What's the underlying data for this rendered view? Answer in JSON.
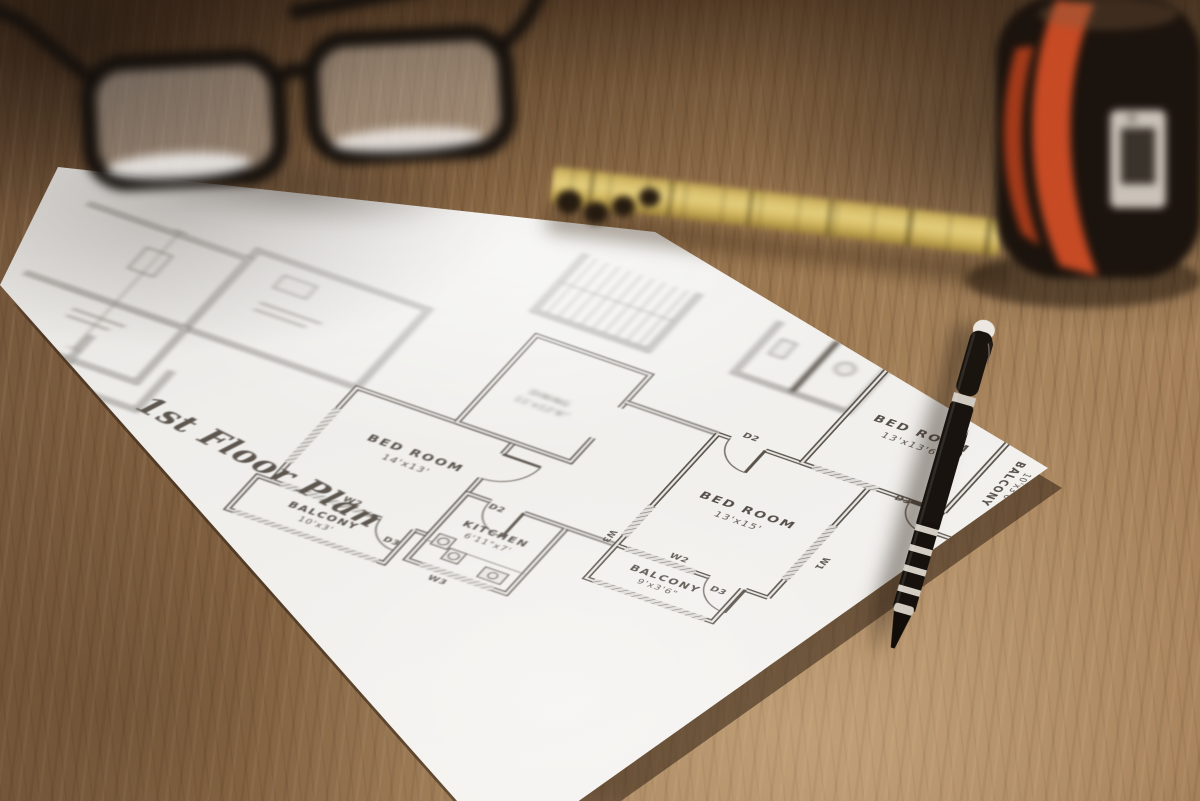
{
  "photo": {
    "surface": "wooden-table",
    "objects": [
      "eyeglasses",
      "folding-ruler",
      "tape-measure",
      "ballpoint-pen",
      "floor-plan-sheet"
    ],
    "colors": {
      "wood": "#8a6a48",
      "paper": "#efedea",
      "ink": "#57504a",
      "ruler_yellow": "#d8bf6a",
      "tape_accent": "#c64a24",
      "pen_black": "#17120d"
    }
  },
  "plan": {
    "title": "1st Floor Plan",
    "rooms": [
      {
        "id": "bedroom-left",
        "name": "BED ROOM",
        "dims": "14'x13'"
      },
      {
        "id": "balcony-left",
        "name": "BALCONY",
        "dims": "10'x3'"
      },
      {
        "id": "kitchen",
        "name": "KITCHEN",
        "dims": "6'11\"x7'"
      },
      {
        "id": "dining",
        "name": "DINING",
        "dims": "11'x12'6\""
      },
      {
        "id": "bedroom-center",
        "name": "BED ROOM",
        "dims": "13'x15'"
      },
      {
        "id": "balcony-center",
        "name": "BALCONY",
        "dims": "9'x3'6\""
      },
      {
        "id": "bedroom-right",
        "name": "BED ROOM",
        "dims": "13'x13'6\""
      },
      {
        "id": "balcony-right",
        "name": "BALCONY",
        "dims": "10'x3'6\""
      }
    ],
    "markers": {
      "w1": "W1",
      "w2": "W2",
      "w3": "W3",
      "d2": "D2",
      "d3": "D3"
    }
  }
}
